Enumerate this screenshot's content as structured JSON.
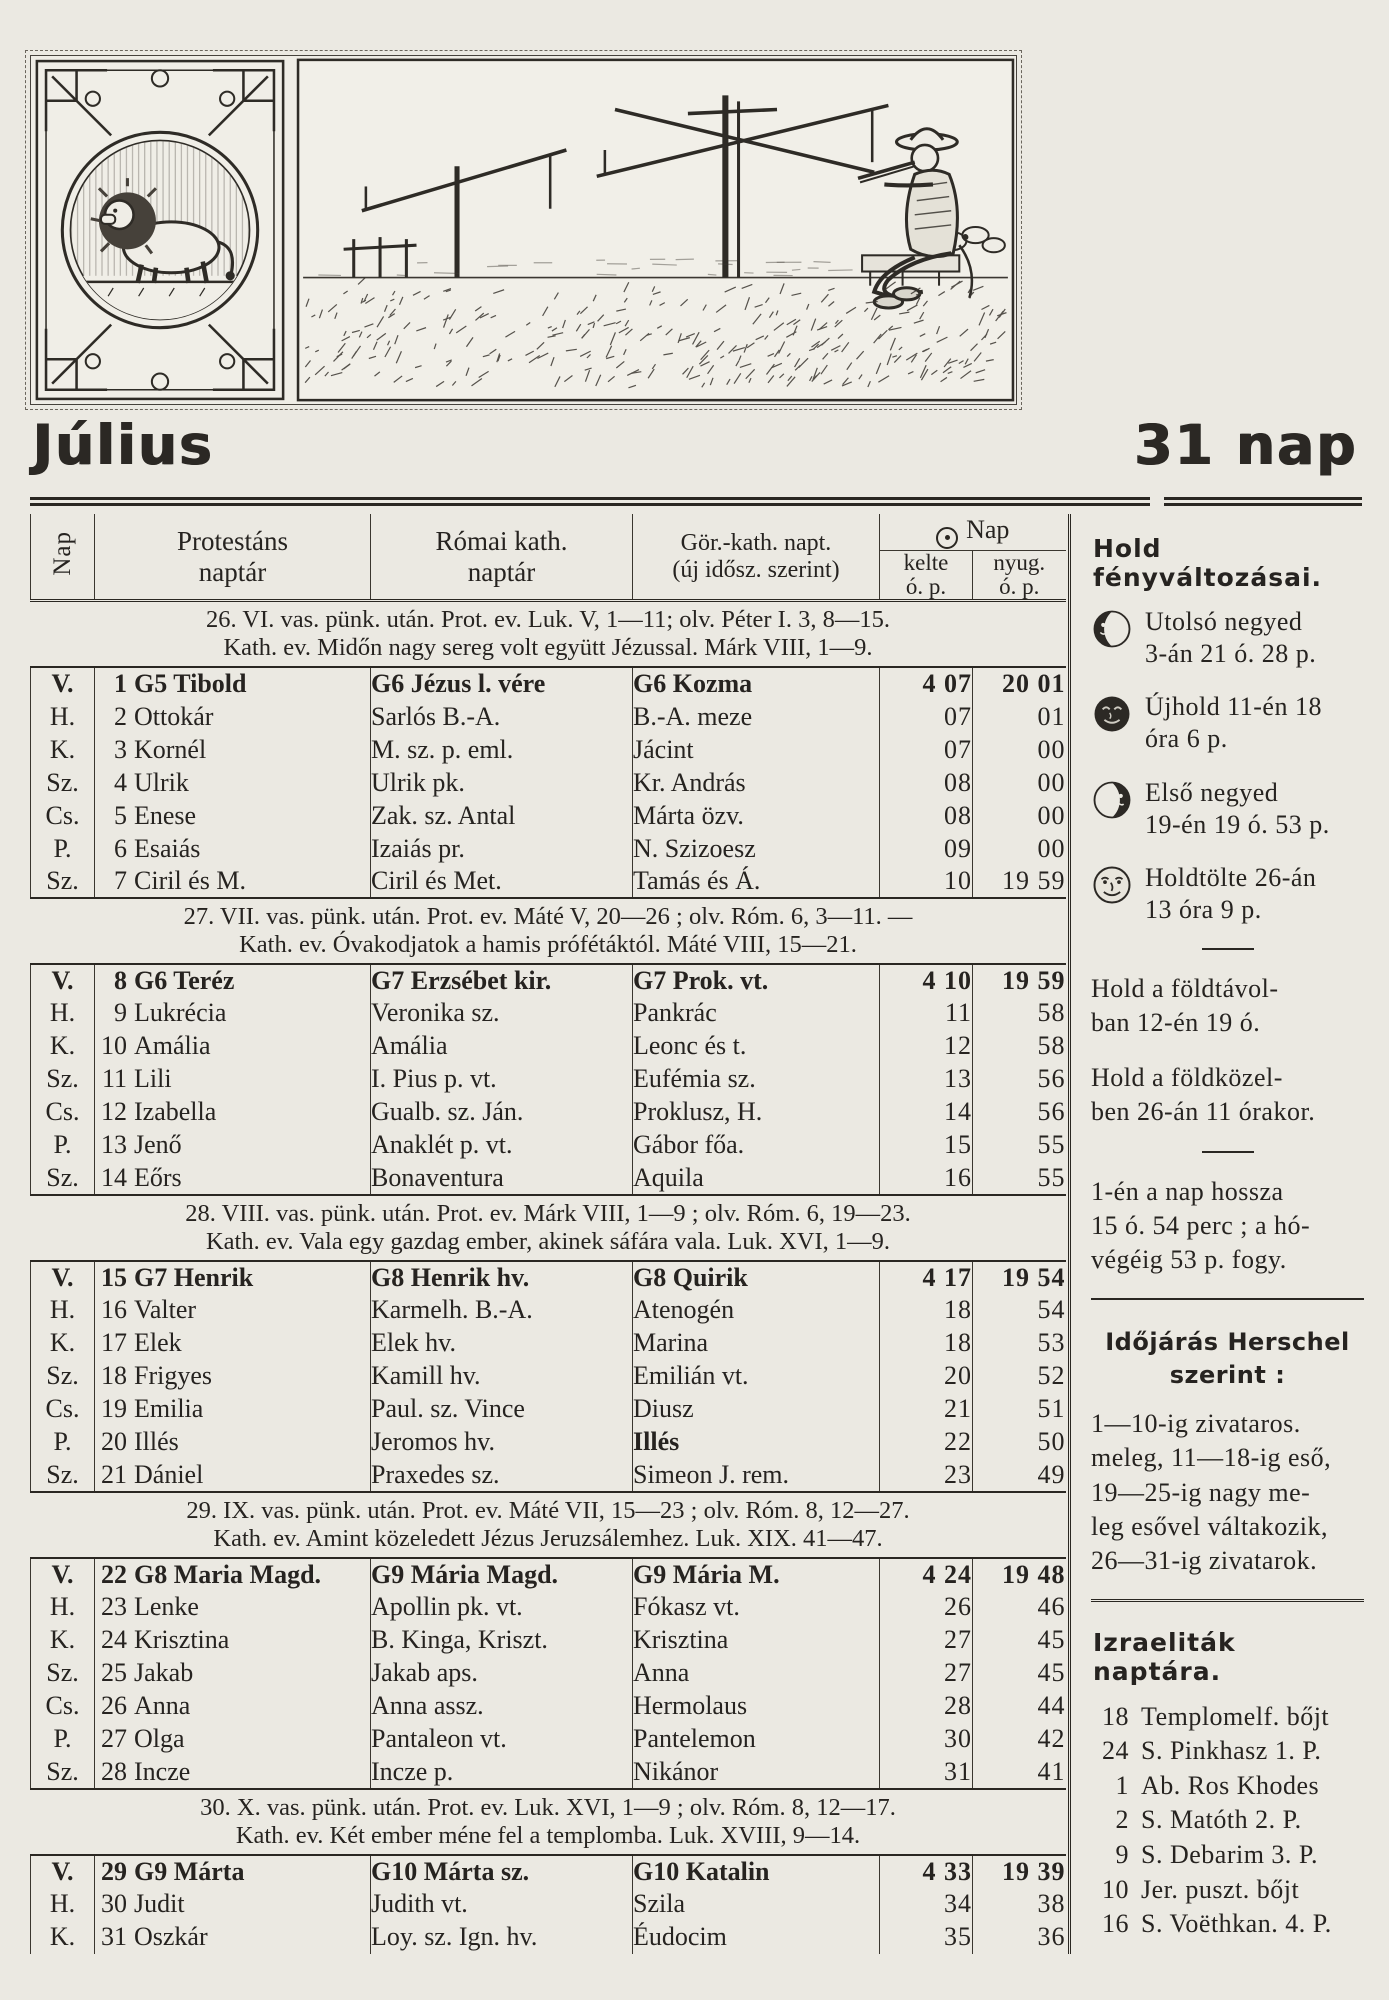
{
  "page": {
    "title": "Július",
    "day_count": "31 nap"
  },
  "banner": {
    "left_icon": "leo-zodiac-illustration",
    "right_icon": "rural-scene-illustration"
  },
  "table": {
    "col_nap": "Nap",
    "col_protestant": "Protestáns\nnaptár",
    "col_roman": "Római kath.\nnaptár",
    "col_greek": "Gör.-kath. napt.\n(új idősz. szerint)",
    "col_sun": "Nap",
    "col_rise": "kelte",
    "col_set": "nyug.",
    "col_unit_rise": "ó. p.",
    "col_unit_set": "ó. p.",
    "weeks": [
      {
        "line1": "26. VI. vas. pünk. után. Prot. ev. Luk. V, 1—11; olv. Péter I. 3, 8—15.",
        "line2": "Kath. ev. Midőn nagy sereg volt együtt Jézussal. Márk VIII, 1—9.",
        "rows": [
          {
            "dow": "V.",
            "day": "1",
            "prot": "G5 Tibold",
            "rom": "G6 Jézus l. vére",
            "gr": "G6 Kozma",
            "rise": "4 07",
            "set": "20 01",
            "sunday": true
          },
          {
            "dow": "H.",
            "day": "2",
            "prot": "Ottokár",
            "rom": "Sarlós B.-A.",
            "gr": "B.-A. meze",
            "rise": "07",
            "set": "01"
          },
          {
            "dow": "K.",
            "day": "3",
            "prot": "Kornél",
            "rom": "M. sz. p. eml.",
            "gr": "Jácint",
            "rise": "07",
            "set": "00"
          },
          {
            "dow": "Sz.",
            "day": "4",
            "prot": "Ulrik",
            "rom": "Ulrik pk.",
            "gr": "Kr. András",
            "rise": "08",
            "set": "00"
          },
          {
            "dow": "Cs.",
            "day": "5",
            "prot": "Enese",
            "rom": "Zak. sz. Antal",
            "gr": "Márta özv.",
            "rise": "08",
            "set": "00"
          },
          {
            "dow": "P.",
            "day": "6",
            "prot": "Esaiás",
            "rom": "Izaiás pr.",
            "gr": "N. Szizoesz",
            "rise": "09",
            "set": "00"
          },
          {
            "dow": "Sz.",
            "day": "7",
            "prot": "Ciril és M.",
            "rom": "Ciril és Met.",
            "gr": "Tamás és Á.",
            "rise": "10",
            "set": "19 59"
          }
        ]
      },
      {
        "line1": "27. VII. vas. pünk. után. Prot. ev. Máté V, 20—26 ; olv. Róm. 6, 3—11. —",
        "line2": "Kath. ev. Óvakodjatok a hamis prófétáktól. Máté VIII, 15—21.",
        "rows": [
          {
            "dow": "V.",
            "day": "8",
            "prot": "G6 Teréz",
            "rom": "G7 Erzsébet kir.",
            "gr": "G7 Prok. vt.",
            "rise": "4 10",
            "set": "19 59",
            "sunday": true
          },
          {
            "dow": "H.",
            "day": "9",
            "prot": "Lukrécia",
            "rom": "Veronika sz.",
            "gr": "Pankrác",
            "rise": "11",
            "set": "58"
          },
          {
            "dow": "K.",
            "day": "10",
            "prot": "Amália",
            "rom": "Amália",
            "gr": "Leonc és t.",
            "rise": "12",
            "set": "58"
          },
          {
            "dow": "Sz.",
            "day": "11",
            "prot": "Lili",
            "rom": "I. Pius p. vt.",
            "gr": "Eufémia sz.",
            "rise": "13",
            "set": "56"
          },
          {
            "dow": "Cs.",
            "day": "12",
            "prot": "Izabella",
            "rom": "Gualb. sz. Ján.",
            "gr": "Proklusz, H.",
            "rise": "14",
            "set": "56"
          },
          {
            "dow": "P.",
            "day": "13",
            "prot": "Jenő",
            "rom": "Anaklét p. vt.",
            "gr": "Gábor főa.",
            "rise": "15",
            "set": "55"
          },
          {
            "dow": "Sz.",
            "day": "14",
            "prot": "Eőrs",
            "rom": "Bonaventura",
            "gr": "Aquila",
            "rise": "16",
            "set": "55"
          }
        ]
      },
      {
        "line1": "28. VIII. vas. pünk. után. Prot. ev. Márk VIII, 1—9 ; olv. Róm. 6, 19—23.",
        "line2": "Kath. ev. Vala egy gazdag ember, akinek sáfára vala. Luk. XVI, 1—9.",
        "rows": [
          {
            "dow": "V.",
            "day": "15",
            "prot": "G7 Henrik",
            "rom": "G8 Henrik hv.",
            "gr": "G8 Quirik",
            "rise": "4 17",
            "set": "19 54",
            "sunday": true
          },
          {
            "dow": "H.",
            "day": "16",
            "prot": "Valter",
            "rom": "Karmelh. B.-A.",
            "gr": "Atenogén",
            "rise": "18",
            "set": "54"
          },
          {
            "dow": "K.",
            "day": "17",
            "prot": "Elek",
            "rom": "Elek hv.",
            "gr": "Marina",
            "rise": "18",
            "set": "53"
          },
          {
            "dow": "Sz.",
            "day": "18",
            "prot": "Frigyes",
            "rom": "Kamill hv.",
            "gr": "Emilián vt.",
            "rise": "20",
            "set": "52"
          },
          {
            "dow": "Cs.",
            "day": "19",
            "prot": "Emilia",
            "rom": "Paul. sz. Vince",
            "gr": "Diusz",
            "rise": "21",
            "set": "51"
          },
          {
            "dow": "P.",
            "day": "20",
            "prot": "Illés",
            "rom": "Jeromos hv.",
            "gr": "Illés",
            "rise": "22",
            "set": "50",
            "gr_bold": true
          },
          {
            "dow": "Sz.",
            "day": "21",
            "prot": "Dániel",
            "rom": "Praxedes sz.",
            "gr": "Simeon J. rem.",
            "rise": "23",
            "set": "49"
          }
        ]
      },
      {
        "line1": "29. IX. vas. pünk. után. Prot. ev. Máté VII, 15—23 ; olv. Róm. 8, 12—27.",
        "line2": "Kath. ev. Amint közeledett Jézus Jeruzsálemhez. Luk. XIX. 41—47.",
        "rows": [
          {
            "dow": "V.",
            "day": "22",
            "prot": "G8 Maria Magd.",
            "rom": "G9 Mária Magd.",
            "gr": "G9 Mária M.",
            "rise": "4 24",
            "set": "19 48",
            "sunday": true
          },
          {
            "dow": "H.",
            "day": "23",
            "prot": "Lenke",
            "rom": "Apollin pk. vt.",
            "gr": "Fókasz vt.",
            "rise": "26",
            "set": "46"
          },
          {
            "dow": "K.",
            "day": "24",
            "prot": "Krisztina",
            "rom": "B. Kinga, Kriszt.",
            "gr": "Krisztina",
            "rise": "27",
            "set": "45"
          },
          {
            "dow": "Sz.",
            "day": "25",
            "prot": "Jakab",
            "rom": "Jakab aps.",
            "gr": "Anna",
            "rise": "27",
            "set": "45"
          },
          {
            "dow": "Cs.",
            "day": "26",
            "prot": "Anna",
            "rom": "Anna assz.",
            "gr": "Hermolaus",
            "rise": "28",
            "set": "44"
          },
          {
            "dow": "P.",
            "day": "27",
            "prot": "Olga",
            "rom": "Pantaleon vt.",
            "gr": "Pantelemon",
            "rise": "30",
            "set": "42"
          },
          {
            "dow": "Sz.",
            "day": "28",
            "prot": "Incze",
            "rom": "Incze p.",
            "gr": "Nikánor",
            "rise": "31",
            "set": "41"
          }
        ]
      },
      {
        "line1": "30. X. vas. pünk. után. Prot. ev. Luk. XVI, 1—9 ; olv. Róm. 8, 12—17.",
        "line2": "Kath. ev. Két ember méne fel a templomba. Luk. XVIII, 9—14.",
        "rows": [
          {
            "dow": "V.",
            "day": "29",
            "prot": "G9 Márta",
            "rom": "G10 Márta sz.",
            "gr": "G10 Katalin",
            "rise": "4 33",
            "set": "19 39",
            "sunday": true
          },
          {
            "dow": "H.",
            "day": "30",
            "prot": "Judit",
            "rom": "Judith vt.",
            "gr": "Szila",
            "rise": "34",
            "set": "38"
          },
          {
            "dow": "K.",
            "day": "31",
            "prot": "Oszkár",
            "rom": "Loy. sz. Ign. hv.",
            "gr": "Éudocim",
            "rise": "35",
            "set": "36"
          }
        ]
      }
    ]
  },
  "sidebar": {
    "heading": "Hold  fényváltozásai.",
    "phases": [
      {
        "icon": "last-quarter-moon-icon",
        "text": "Utolsó  negyed\n3-án 21 ó. 28 p."
      },
      {
        "icon": "new-moon-icon",
        "text": "Újhold 11-én 18\nóra 6 p."
      },
      {
        "icon": "first-quarter-moon-icon",
        "text": "Első negyed\n19-én 19 ó. 53 p."
      },
      {
        "icon": "full-moon-icon",
        "text": "Holdtölte 26-án\n13 óra 9 p."
      }
    ],
    "apogee": "Hold a földtávol-\nban 12-én 19 ó.",
    "perigee": "Hold a földközel-\nben 26-án 11 órakor.",
    "day_length": "1-én a nap hossza\n15 ó. 54 perc ; a hó-\nvégéig 53 p. fogy.",
    "weather_heading": "Időjárás Herschel\nszerint :",
    "weather_text": "1—10-ig zivataros.\nmeleg, 11—18-ig eső,\n19—25-ig nagy me-\nleg esővel váltakozik,\n26—31-ig zivatarok.",
    "israelite_heading": "Izraeliták  naptára.",
    "israelite_items": [
      {
        "num": "18",
        "label": "Templomelf. bőjt"
      },
      {
        "num": "24",
        "label": "S. Pinkhasz 1. P."
      },
      {
        "num": "1",
        "label": "Ab. Ros Khodes"
      },
      {
        "num": "2",
        "label": "S. Matóth 2. P."
      },
      {
        "num": "9",
        "label": "S. Debarim 3. P."
      },
      {
        "num": "10",
        "label": "Jer. puszt. bőjt"
      },
      {
        "num": "16",
        "label": "S. Voëthkan. 4. P."
      }
    ]
  }
}
